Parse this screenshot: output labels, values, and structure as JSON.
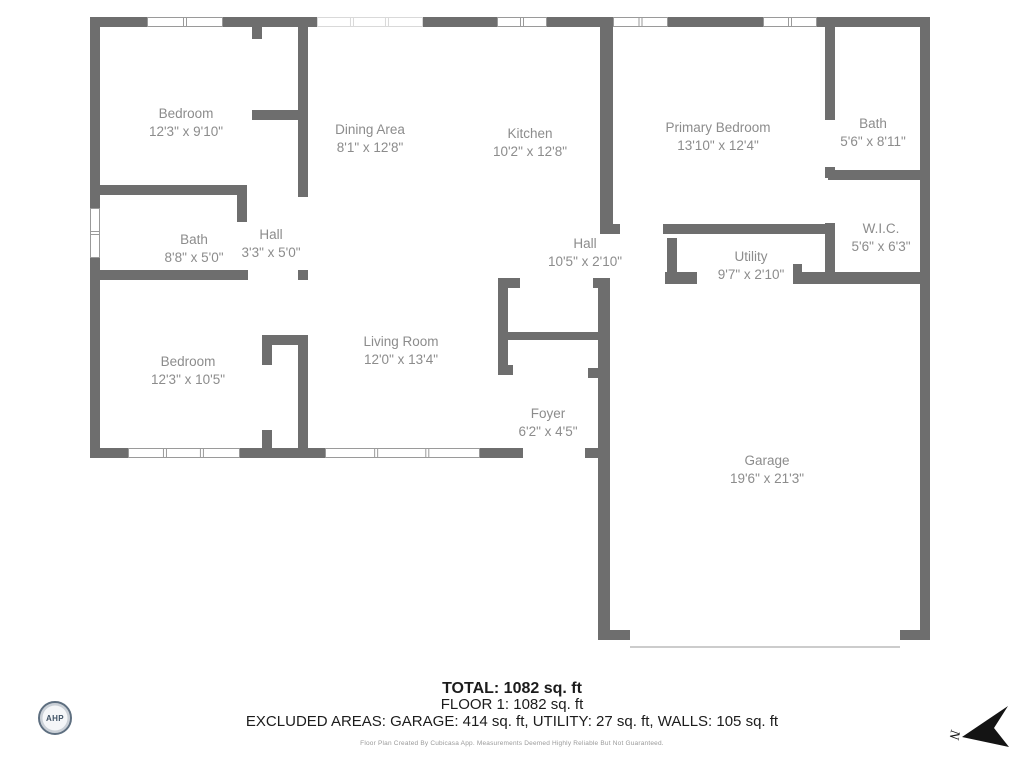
{
  "plan": {
    "wall_color": "#6e6e6e",
    "window_border_color": "#9a9a9a",
    "light_window_border_color": "#d9d9d9",
    "label_color": "#8c8c8c",
    "garage_door_color": "#cccccc",
    "rooms": [
      {
        "name": "Bedroom",
        "dims": "12'3\" x 9'10\"",
        "x": 186,
        "y": 118
      },
      {
        "name": "Dining Area",
        "dims": "8'1\" x 12'8\"",
        "x": 370,
        "y": 134
      },
      {
        "name": "Kitchen",
        "dims": "10'2\" x 12'8\"",
        "x": 530,
        "y": 138
      },
      {
        "name": "Primary Bedroom",
        "dims": "13'10\" x 12'4\"",
        "x": 718,
        "y": 132
      },
      {
        "name": "Bath",
        "dims": "5'6\" x 8'11\"",
        "x": 873,
        "y": 128
      },
      {
        "name": "W.I.C.",
        "dims": "5'6\" x 6'3\"",
        "x": 881,
        "y": 233
      },
      {
        "name": "Utility",
        "dims": "9'7\" x 2'10\"",
        "x": 751,
        "y": 261
      },
      {
        "name": "Hall",
        "dims": "10'5\" x 2'10\"",
        "x": 585,
        "y": 248
      },
      {
        "name": "Bath",
        "dims": "8'8\" x 5'0\"",
        "x": 194,
        "y": 244
      },
      {
        "name": "Hall",
        "dims": "3'3\" x 5'0\"",
        "x": 271,
        "y": 239
      },
      {
        "name": "Bedroom",
        "dims": "12'3\" x 10'5\"",
        "x": 188,
        "y": 366
      },
      {
        "name": "Living Room",
        "dims": "12'0\" x 13'4\"",
        "x": 401,
        "y": 346
      },
      {
        "name": "Foyer",
        "dims": "6'2\" x 4'5\"",
        "x": 548,
        "y": 418
      },
      {
        "name": "Garage",
        "dims": "19'6\" x 21'3\"",
        "x": 767,
        "y": 465
      }
    ],
    "walls": [
      [
        90,
        17,
        57,
        10
      ],
      [
        223,
        17,
        94,
        10
      ],
      [
        423,
        17,
        74,
        10
      ],
      [
        547,
        17,
        66,
        10
      ],
      [
        668,
        17,
        95,
        10
      ],
      [
        817,
        17,
        113,
        10
      ],
      [
        90,
        17,
        10,
        191
      ],
      [
        90,
        258,
        10,
        200
      ],
      [
        920,
        17,
        10,
        623
      ],
      [
        90,
        448,
        38,
        10
      ],
      [
        240,
        448,
        85,
        10
      ],
      [
        480,
        448,
        43,
        10
      ],
      [
        585,
        448,
        25,
        10
      ],
      [
        598,
        630,
        32,
        10
      ],
      [
        900,
        630,
        30,
        10
      ],
      [
        252,
        27,
        10,
        12
      ],
      [
        252,
        110,
        46,
        10
      ],
      [
        298,
        27,
        10,
        170
      ],
      [
        90,
        185,
        157,
        10
      ],
      [
        237,
        195,
        10,
        27
      ],
      [
        90,
        270,
        158,
        10
      ],
      [
        298,
        270,
        10,
        10
      ],
      [
        262,
        335,
        36,
        10
      ],
      [
        262,
        335,
        10,
        30
      ],
      [
        262,
        430,
        10,
        18
      ],
      [
        298,
        335,
        10,
        113
      ],
      [
        498,
        278,
        10,
        97
      ],
      [
        498,
        278,
        22,
        10
      ],
      [
        593,
        278,
        17,
        10
      ],
      [
        505,
        332,
        105,
        8
      ],
      [
        498,
        365,
        15,
        10
      ],
      [
        588,
        368,
        10,
        10
      ],
      [
        598,
        278,
        12,
        362
      ],
      [
        600,
        27,
        13,
        197
      ],
      [
        600,
        224,
        20,
        10
      ],
      [
        663,
        224,
        172,
        10
      ],
      [
        667,
        238,
        10,
        40
      ],
      [
        665,
        272,
        32,
        12
      ],
      [
        793,
        272,
        137,
        12
      ],
      [
        793,
        264,
        9,
        8
      ],
      [
        825,
        27,
        10,
        93
      ],
      [
        825,
        167,
        10,
        11
      ],
      [
        828,
        170,
        102,
        10
      ],
      [
        825,
        223,
        10,
        55
      ]
    ],
    "windows": [
      {
        "x": 147,
        "y": 17,
        "w": 76,
        "h": 10,
        "orient": "h",
        "light": false
      },
      {
        "x": 317,
        "y": 17,
        "w": 106,
        "h": 10,
        "orient": "h",
        "light": true
      },
      {
        "x": 497,
        "y": 17,
        "w": 50,
        "h": 10,
        "orient": "h",
        "light": false
      },
      {
        "x": 613,
        "y": 17,
        "w": 55,
        "h": 10,
        "orient": "h",
        "light": false
      },
      {
        "x": 763,
        "y": 17,
        "w": 54,
        "h": 10,
        "orient": "h",
        "light": false
      },
      {
        "x": 128,
        "y": 448,
        "w": 112,
        "h": 10,
        "orient": "h",
        "light": false
      },
      {
        "x": 325,
        "y": 448,
        "w": 155,
        "h": 10,
        "orient": "h",
        "light": false
      },
      {
        "x": 90,
        "y": 208,
        "w": 10,
        "h": 50,
        "orient": "v",
        "light": false
      }
    ],
    "garage_door_line": {
      "x": 630,
      "y": 646,
      "w": 270,
      "h": 2
    }
  },
  "footer": {
    "total": "TOTAL: 1082 sq. ft",
    "floor": "FLOOR 1: 1082 sq. ft",
    "excluded": "EXCLUDED AREAS: GARAGE: 414 sq. ft, UTILITY: 27 sq. ft, WALLS: 105 sq. ft",
    "disclaimer": "Floor Plan Created By Cubicasa App. Measurements Deemed Highly Reliable But Not Guaranteed."
  },
  "logo": {
    "text": "AHP"
  },
  "compass": {
    "label": "N"
  }
}
